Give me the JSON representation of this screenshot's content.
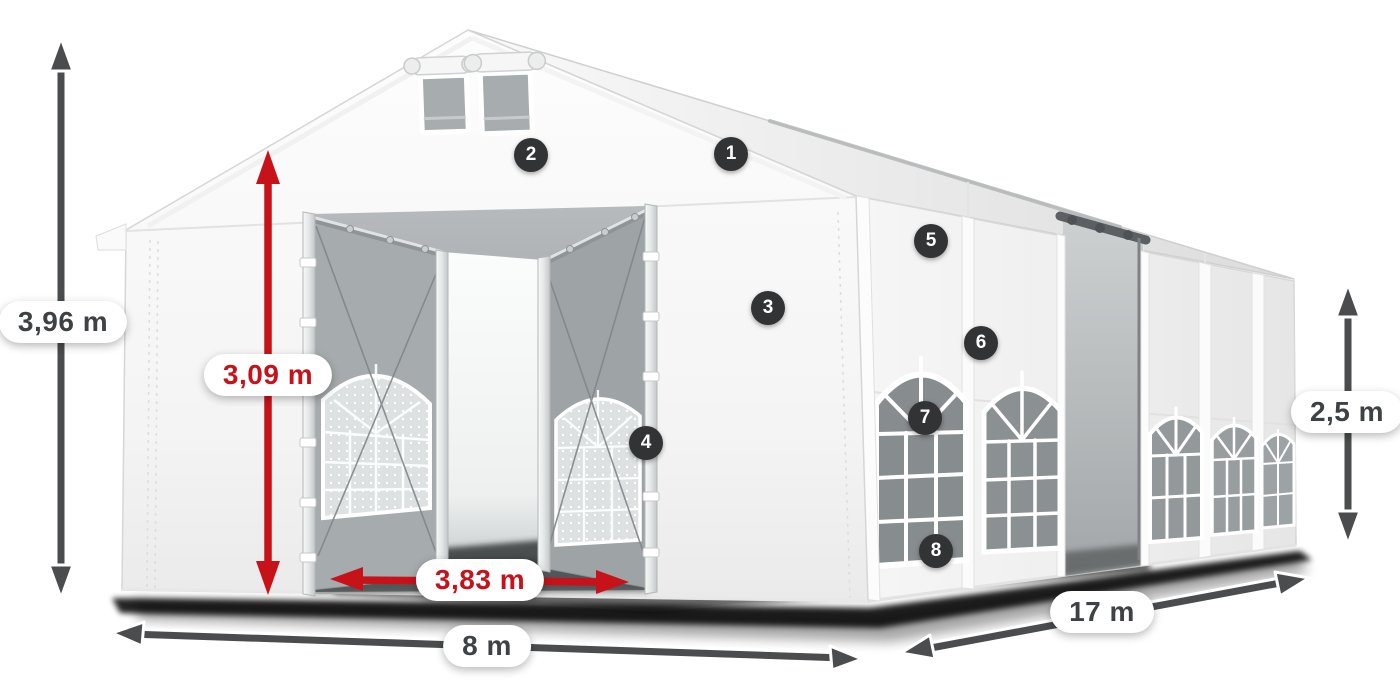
{
  "dimensions": {
    "total_height": "3,96 m",
    "entrance_height": "3,09 m",
    "entrance_width": "3,83 m",
    "front_width": "8 m",
    "side_length": "17 m",
    "side_height": "2,5 m"
  },
  "markers": [
    "1",
    "2",
    "3",
    "4",
    "5",
    "6",
    "7",
    "8"
  ],
  "colors": {
    "dimension_red": "#c8121a",
    "dimension_gray": "#4a4c4d",
    "badge_background": "#313335",
    "badge_text": "#ffffff",
    "tent_fabric": "#f6f6f6"
  }
}
